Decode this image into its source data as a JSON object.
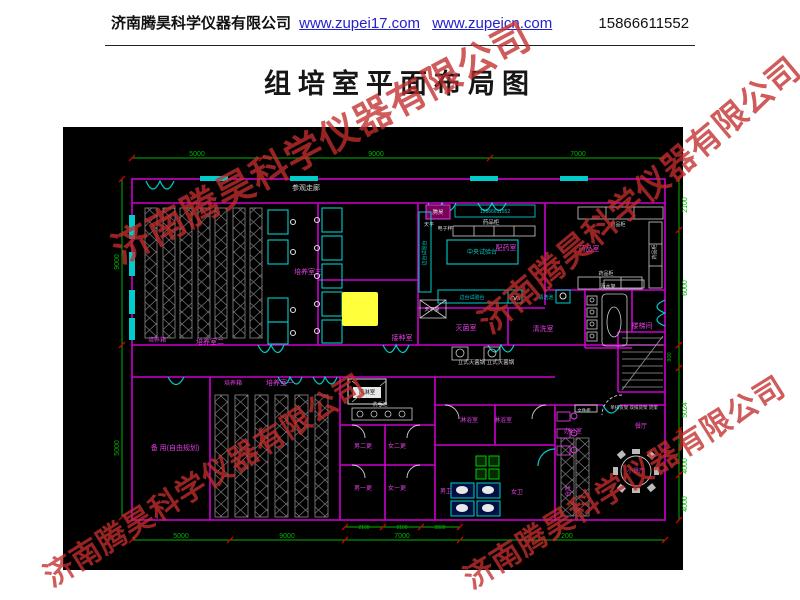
{
  "header": {
    "company": "济南腾昊科学仪器有限公司",
    "url1": "www.zupei17.com",
    "url2": "www.zupeicn.com",
    "phone": "15866611552"
  },
  "title": "组培室平面布局图",
  "watermark": {
    "text": "济南腾昊科学仪器有限公司",
    "instances": [
      {
        "x": 320,
        "y": 140,
        "rot": -28,
        "fs": 38
      },
      {
        "x": 638,
        "y": 193,
        "rot": -40,
        "fs": 33
      },
      {
        "x": 203,
        "y": 478,
        "rot": -32,
        "fs": 30
      },
      {
        "x": 623,
        "y": 480,
        "rot": -32,
        "fs": 30
      }
    ]
  },
  "colors": {
    "wall": "#cc00cc",
    "fixture": "#00cccc",
    "dim": "#00b400",
    "tick": "#cc0000",
    "room_label": "#e040e0",
    "white_label": "#d8d8d8",
    "rack": "#8a8a8a",
    "highlight": "#ffff3c",
    "black_label": "#111111"
  },
  "plan": {
    "dim_labels": [
      {
        "t": "5000",
        "x": 197,
        "y": 156,
        "c": "g",
        "fs": 7
      },
      {
        "t": "9000",
        "x": 376,
        "y": 156,
        "c": "g",
        "fs": 7
      },
      {
        "t": "7000",
        "x": 578,
        "y": 156,
        "c": "g",
        "fs": 7
      },
      {
        "t": "9000",
        "x": 119,
        "y": 262,
        "c": "g",
        "fs": 7,
        "r": -90
      },
      {
        "t": "5000",
        "x": 119,
        "y": 448,
        "c": "g",
        "fs": 7,
        "r": -90
      },
      {
        "t": "2100",
        "x": 687,
        "y": 205,
        "c": "g",
        "fs": 7,
        "r": -90
      },
      {
        "t": "6000",
        "x": 687,
        "y": 288,
        "c": "g",
        "fs": 7,
        "r": -90
      },
      {
        "t": "900",
        "x": 671,
        "y": 357,
        "c": "g",
        "fs": 5.5,
        "r": -90
      },
      {
        "t": "5024",
        "x": 687,
        "y": 410,
        "c": "g",
        "fs": 7,
        "r": -90
      },
      {
        "t": "4000",
        "x": 687,
        "y": 466,
        "c": "g",
        "fs": 7,
        "r": -90
      },
      {
        "t": "4000",
        "x": 687,
        "y": 504,
        "c": "g",
        "fs": 7,
        "r": -90
      },
      {
        "t": "5000",
        "x": 181,
        "y": 538,
        "c": "g",
        "fs": 7
      },
      {
        "t": "9000",
        "x": 287,
        "y": 538,
        "c": "g",
        "fs": 7
      },
      {
        "t": "7000",
        "x": 402,
        "y": 538,
        "c": "g",
        "fs": 7
      },
      {
        "t": "7200",
        "x": 565,
        "y": 538,
        "c": "g",
        "fs": 7
      },
      {
        "t": "2100",
        "x": 364,
        "y": 529,
        "c": "g",
        "fs": 5
      },
      {
        "t": "2100",
        "x": 402,
        "y": 529,
        "c": "g",
        "fs": 5
      },
      {
        "t": "2800",
        "x": 440,
        "y": 529,
        "c": "g",
        "fs": 5
      }
    ],
    "room_labels": [
      {
        "t": "参观走廊",
        "x": 306,
        "y": 190,
        "c": "w",
        "fs": 7
      },
      {
        "t": "培养箱",
        "x": 157,
        "y": 342,
        "c": "m",
        "fs": 6
      },
      {
        "t": "培养室二",
        "x": 210,
        "y": 344,
        "c": "m",
        "fs": 7
      },
      {
        "t": "培养室三",
        "x": 308,
        "y": 274,
        "c": "m",
        "fs": 7
      },
      {
        "t": "接种室",
        "x": 402,
        "y": 340,
        "c": "m",
        "fs": 7
      },
      {
        "t": "配药室",
        "x": 506,
        "y": 250,
        "c": "m",
        "fs": 7
      },
      {
        "t": "药品室",
        "x": 589,
        "y": 251,
        "c": "m",
        "fs": 7
      },
      {
        "t": "灭菌室",
        "x": 466,
        "y": 330,
        "c": "m",
        "fs": 7
      },
      {
        "t": "清洗室",
        "x": 543,
        "y": 331,
        "c": "m",
        "fs": 7
      },
      {
        "t": "楼梯间",
        "x": 642,
        "y": 328,
        "c": "m",
        "fs": 7
      },
      {
        "t": "培养箱",
        "x": 233,
        "y": 385,
        "c": "m",
        "fs": 6
      },
      {
        "t": "培养室一",
        "x": 280,
        "y": 385,
        "c": "m",
        "fs": 7
      },
      {
        "t": "备 用(自由规划)",
        "x": 175,
        "y": 450,
        "c": "m",
        "fs": 7
      },
      {
        "t": "男二更",
        "x": 363,
        "y": 448,
        "c": "m",
        "fs": 6
      },
      {
        "t": "女二更",
        "x": 397,
        "y": 448,
        "c": "m",
        "fs": 6
      },
      {
        "t": "男一更",
        "x": 363,
        "y": 490,
        "c": "m",
        "fs": 6
      },
      {
        "t": "女一更",
        "x": 397,
        "y": 490,
        "c": "m",
        "fs": 6
      },
      {
        "t": "淋浴室",
        "x": 469,
        "y": 422,
        "c": "m",
        "fs": 6
      },
      {
        "t": "淋浴室",
        "x": 503,
        "y": 422,
        "c": "m",
        "fs": 6
      },
      {
        "t": "男卫",
        "x": 446,
        "y": 493,
        "c": "m",
        "fs": 6
      },
      {
        "t": "女卫",
        "x": 517,
        "y": 494,
        "c": "m",
        "fs": 6
      },
      {
        "t": "办公室",
        "x": 573,
        "y": 433,
        "c": "m",
        "fs": 6
      },
      {
        "t": "餐厅",
        "x": 641,
        "y": 428,
        "c": "m",
        "fs": 6
      },
      {
        "t": "小餐厅",
        "x": 636,
        "y": 473,
        "c": "m",
        "fs": 6
      },
      {
        "t": "仓库",
        "x": 570,
        "y": 491,
        "c": "m",
        "fs": 6,
        "r": -90
      }
    ],
    "equipment_labels": [
      {
        "t": "药品柜",
        "x": 491,
        "y": 224,
        "c": "w",
        "fs": 5.5
      },
      {
        "t": "天平",
        "x": 429,
        "y": 226,
        "c": "w",
        "fs": 5
      },
      {
        "t": "电子秤",
        "x": 445,
        "y": 230,
        "c": "w",
        "fs": 5
      },
      {
        "t": "中央试验台",
        "x": 482,
        "y": 254,
        "c": "c",
        "fs": 6
      },
      {
        "t": "边台试验台",
        "x": 426,
        "y": 253,
        "c": "c",
        "fs": 5,
        "r": -90
      },
      {
        "t": "边台试验台",
        "x": 472,
        "y": 299,
        "c": "c",
        "fs": 5
      },
      {
        "t": "药品柜",
        "x": 618,
        "y": 226,
        "c": "w",
        "fs": 5
      },
      {
        "t": "药品柜",
        "x": 656,
        "y": 252,
        "c": "w",
        "fs": 5,
        "r": -90
      },
      {
        "t": "药品柜",
        "x": 606,
        "y": 275,
        "c": "w",
        "fs": 5
      },
      {
        "t": "沥水架",
        "x": 608,
        "y": 288,
        "c": "w",
        "fs": 5
      },
      {
        "t": "清洗池",
        "x": 546,
        "y": 299,
        "c": "c",
        "fs": 5
      },
      {
        "t": "天平桌",
        "x": 432,
        "y": 311,
        "c": "w",
        "fs": 5
      },
      {
        "t": "立式灭菌锅 立式灭菌锅",
        "x": 486,
        "y": 364,
        "c": "w",
        "fs": 5.5
      },
      {
        "t": "风淋室",
        "x": 367,
        "y": 394,
        "c": "k",
        "fs": 5.5
      },
      {
        "t": "洗手池",
        "x": 380,
        "y": 406,
        "c": "w",
        "fs": 5
      },
      {
        "t": "文件柜",
        "x": 584,
        "y": 412,
        "c": "w",
        "fs": 4.5
      },
      {
        "t": "单排货架 双排货架 货架",
        "x": 634,
        "y": 409,
        "c": "w",
        "fs": 4.5
      },
      {
        "t": "腾昊",
        "x": 438,
        "y": 214,
        "c": "w",
        "fs": 5.5
      },
      {
        "t": "15866611552",
        "x": 495,
        "y": 213,
        "c": "c",
        "fs": 5
      }
    ]
  }
}
